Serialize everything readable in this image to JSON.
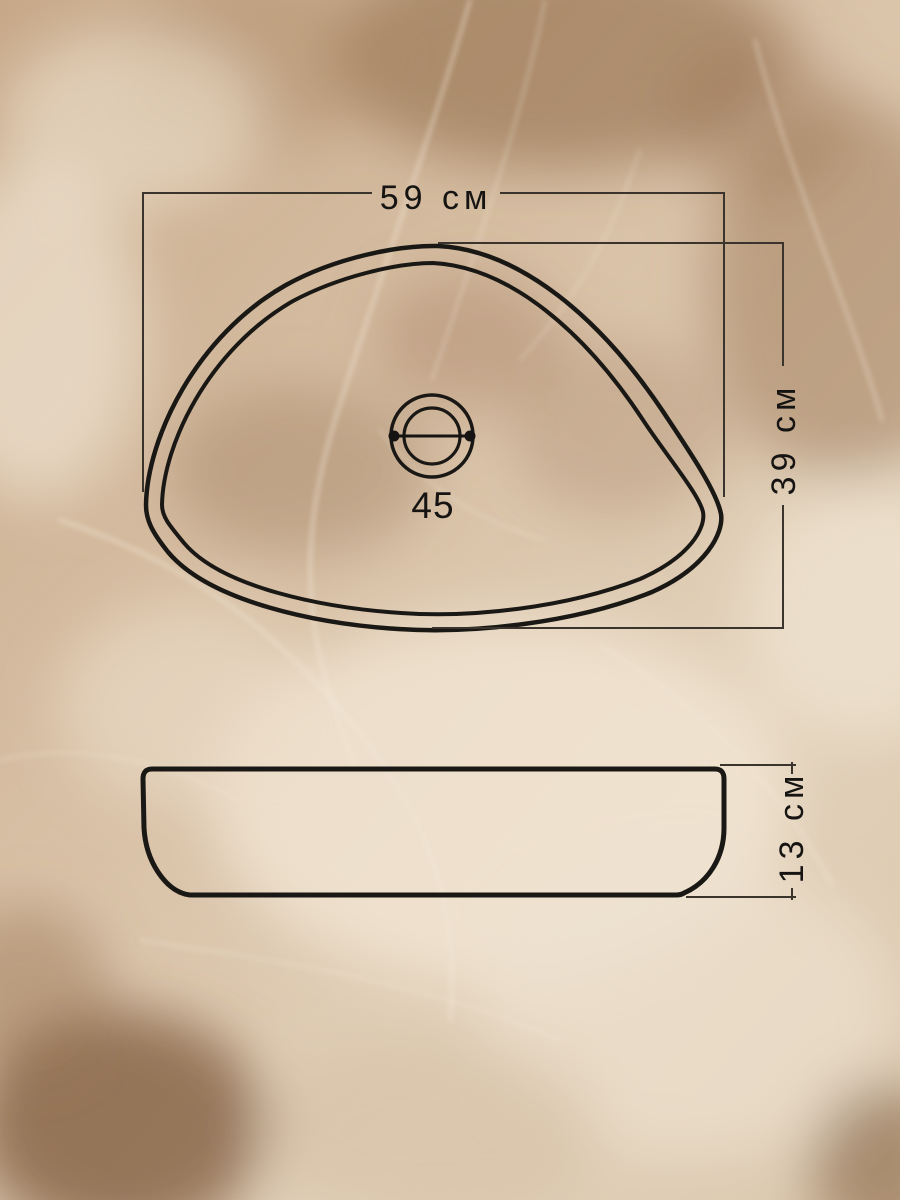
{
  "diagram": {
    "description": "Technical dimension drawing of a triangular vessel sink on a beige marble background",
    "top_view": {
      "width_label": "59 см",
      "depth_label": "39 см",
      "drain_diameter_label": "45"
    },
    "side_view": {
      "height_label": "13 см"
    },
    "colors": {
      "outline": "#1a1815",
      "dimension_line": "#3a342d",
      "label_text": "#161412",
      "marble_base": "#d5bda2",
      "marble_light_vein": "#f2e8d7",
      "marble_dark_patch": "#8a6544"
    }
  }
}
